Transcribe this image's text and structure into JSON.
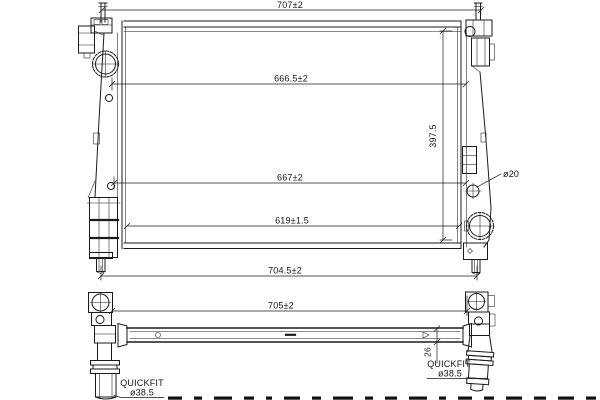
{
  "document": {
    "type": "radiator dimensional drawing"
  },
  "colors": {
    "line": "#1b1b1b",
    "background": "#ffffff"
  },
  "main_view": {
    "dims": {
      "width_top": "707±2",
      "width_upper": "666.5±2",
      "width_mid": "667±2",
      "width_lower": "619±1.5",
      "width_bottom": "704.5±2",
      "core_height": "397.5",
      "mount_hole_dia": "ø20"
    }
  },
  "bottom_view": {
    "dims": {
      "overall_width": "705±2",
      "beam_thickness": "26"
    },
    "left_fitting": {
      "label": "QUICKFIT",
      "diameter": "ø38.5"
    },
    "right_fitting": {
      "label": "QUICKFIT",
      "diameter": "ø38.5"
    }
  }
}
